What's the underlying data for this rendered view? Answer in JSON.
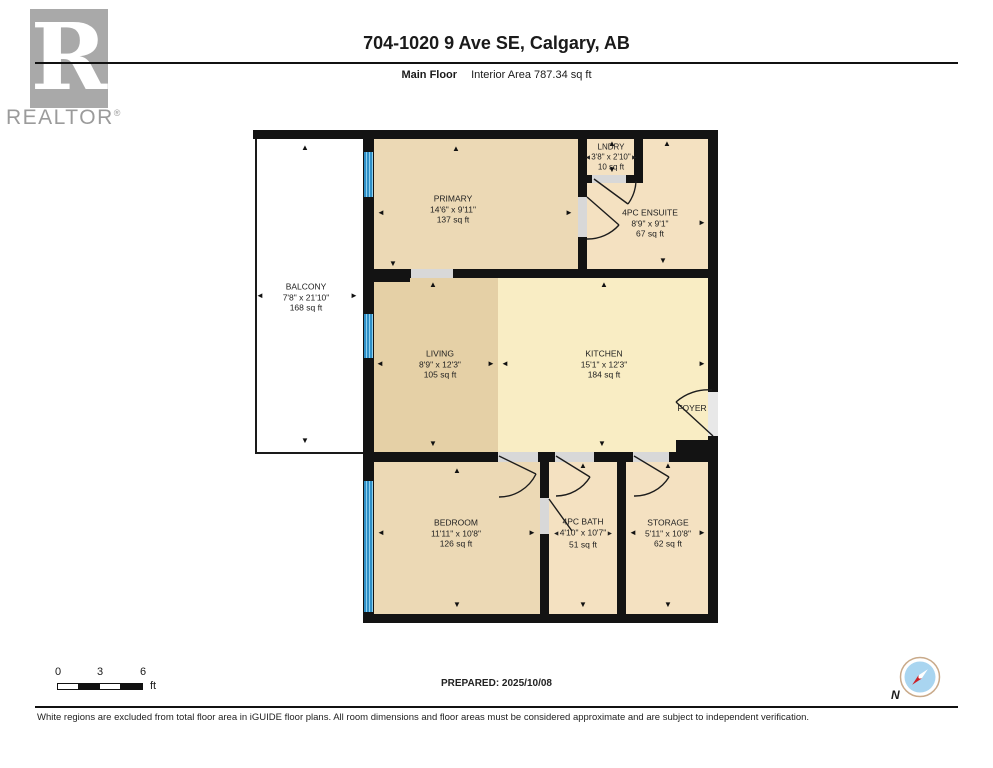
{
  "header": {
    "logo_letter": "R",
    "logo_wordmark": "REALTOR",
    "logo_registered": "®",
    "title": "704-1020 9 Ave SE, Calgary, AB",
    "floor_label": "Main Floor",
    "area_label": "Interior Area 787.34 sq ft"
  },
  "plan": {
    "rooms": [
      {
        "name": "BALCONY",
        "dims": "7'8\" x 21'10\"",
        "area": "168 sq ft"
      },
      {
        "name": "PRIMARY",
        "dims": "14'6\" x 9'11\"",
        "area": "137 sq ft"
      },
      {
        "name": "LNDRY",
        "dims": "3'8\" x 2'10\"",
        "area": "10 sq ft"
      },
      {
        "name": "4PC ENSUITE",
        "dims": "8'9\" x 9'1\"",
        "area": "67 sq ft"
      },
      {
        "name": "LIVING",
        "dims": "8'9\" x 12'3\"",
        "area": "105 sq ft"
      },
      {
        "name": "KITCHEN",
        "dims": "15'1\" x 12'3\"",
        "area": "184 sq ft"
      },
      {
        "name": "FOYER"
      },
      {
        "name": "BEDROOM",
        "dims": "11'11\" x 10'8\"",
        "area": "126 sq ft"
      },
      {
        "name": "4PC BATH",
        "dims": "4'10\" x 10'7\"",
        "area": "51 sq ft"
      },
      {
        "name": "STORAGE",
        "dims": "5'11\" x 10'8\"",
        "area": "62 sq ft"
      }
    ]
  },
  "icons": {
    "arrow_up": "▲",
    "arrow_down": "▼",
    "arrow_left": "◄",
    "arrow_right": "►"
  },
  "footer": {
    "scale_tick_0": "0",
    "scale_tick_3": "3",
    "scale_tick_6": "6",
    "scale_unit": "ft",
    "prepared": "PREPARED: 2025/10/08",
    "compass_label": "N",
    "disclaimer": "White regions are excluded from total floor area in iGUIDE floor plans. All room dimensions and floor areas must be considered approximate and are subject to independent verification."
  },
  "colors": {
    "wall": "#131313",
    "room_beige": "#ecd9b5",
    "room_beige_light": "#f4e1c1",
    "room_living": "#e5d0a6",
    "room_kitchen": "#f9edc4",
    "door_opening": "#d8d8d8",
    "window_blue": "#3e9bd3",
    "compass_red": "#cc2027",
    "compass_blue": "#a9d5f0"
  }
}
